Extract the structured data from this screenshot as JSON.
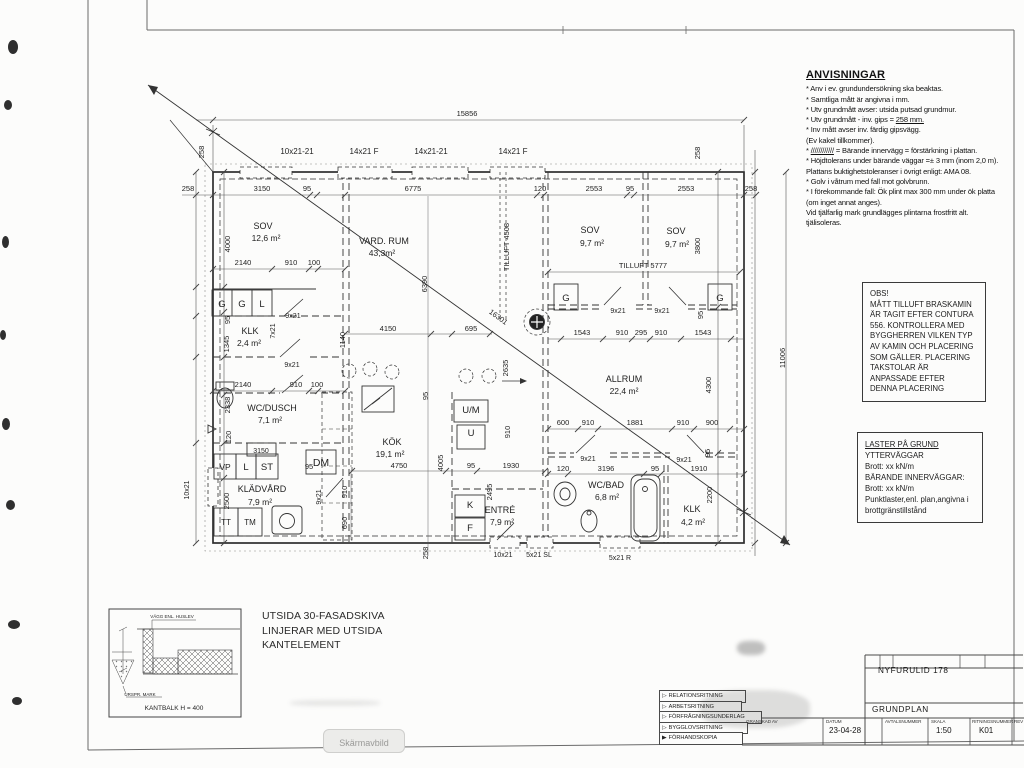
{
  "anvisningar": {
    "title": "ANVISNINGAR",
    "lines": [
      "* Anv i ev. grundundersökning ska beaktas.",
      "*  Samtliga mått är angivna i mm.",
      "* Utv grundmått avser: utsida putsad grundmur.",
      "* Utv grundmått - inv. gips =  ||258 mm.||",
      "* Inv mått avser inv. färdig gipsvägg.",
      "  (Ev kakel tillkommer).",
      "* ||////////////|| = Bärande innervägg = förstärkning i plattan.",
      "* Höjdtolerans under bärande väggar =± 3 mm (inom 2,0 m).",
      "  Plattans buktighetstoleranser i övrigt enligt:  AMA 08.",
      "* Golv i våtrum med fall mot golvbrunn.",
      "* I förekommande fall: Ök plint max 300 mm under ök platta",
      "  (om inget annat anges).",
      "  Vid tjälfarlig mark grundlägges plintarna frostfritt alt.",
      "  tjälisoleras."
    ]
  },
  "obs": {
    "lines": [
      "OBS!",
      "MÅTT TILLUFT BRASKAMIN",
      "ÄR TAGIT EFTER CONTURA",
      "556. KONTROLLERA MED",
      "BYGGHERREN VILKEN TYP",
      "AV KAMIN OCH PLACERING",
      "SOM GÄLLER. PLACERING",
      "TAKSTOLAR ÄR",
      "ANPASSADE EFTER",
      "DENNA PLACERING"
    ]
  },
  "laster": {
    "lines": [
      "||LASTER PÅ GRUND||",
      "",
      "YTTERVÄGGAR",
      "Brott: xx kN/m",
      "",
      "BÄRANDE INNERVÄGGAR:",
      "Brott: xx kN/m",
      "",
      "Punktlaster,enl. plan,angivna i",
      "brottgränstillstånd"
    ]
  },
  "detail": {
    "note_lines": [
      "UTSIDA 30-FASADSKIVA",
      "LINJERAR MED UTSIDA",
      "KANTELEMENT"
    ]
  },
  "title_block": {
    "project": "NYFURULID  178",
    "drawing": "GRUNDPLAN",
    "granskad_label": "GRANSKAD AV",
    "categories": [
      "RELATIONSRITNING",
      "ARBETSRITNING",
      "FÖRFRÅGNINGSUNDERLAG",
      "BYGGLOVSRITNING",
      "FÖRHANDSKOPIA"
    ],
    "fields": [
      {
        "label": "DATUM",
        "value": "23-04-28"
      },
      {
        "label": "AVTALSNUMMER",
        "value": ""
      },
      {
        "label": "SKALA",
        "value": "1:50"
      },
      {
        "label": "RITNINGSNUMMER",
        "value": "K01"
      },
      {
        "label": "REV",
        "value": ""
      }
    ]
  },
  "overlay": {
    "screenshot_label": "Skärmavbild"
  },
  "plan_labels": [
    {
      "t": "15856",
      "x": 467,
      "y": 116
    },
    {
      "t": "10x21-21",
      "x": 297,
      "y": 154,
      "s": 8
    },
    {
      "t": "14x21 F",
      "x": 364,
      "y": 154,
      "s": 8
    },
    {
      "t": "14x21-21",
      "x": 431,
      "y": 154,
      "s": 8
    },
    {
      "t": "14x21 F",
      "x": 513,
      "y": 154,
      "s": 8
    },
    {
      "t": "258",
      "x": 204,
      "y": 152,
      "r": -90
    },
    {
      "t": "258",
      "x": 700,
      "y": 153,
      "r": -90
    },
    {
      "t": "258",
      "x": 188,
      "y": 191
    },
    {
      "t": "3150",
      "x": 262,
      "y": 191
    },
    {
      "t": "95",
      "x": 307,
      "y": 191
    },
    {
      "t": "6775",
      "x": 413,
      "y": 191
    },
    {
      "t": "120",
      "x": 540,
      "y": 191
    },
    {
      "t": "2553",
      "x": 594,
      "y": 191
    },
    {
      "t": "95",
      "x": 630,
      "y": 191
    },
    {
      "t": "2553",
      "x": 686,
      "y": 191
    },
    {
      "t": "258",
      "x": 751,
      "y": 191
    },
    {
      "t": "4000",
      "x": 230,
      "y": 244,
      "r": -90
    },
    {
      "t": "95",
      "x": 230,
      "y": 320,
      "r": -90
    },
    {
      "t": "1345",
      "x": 229,
      "y": 344,
      "r": -90
    },
    {
      "t": "2338",
      "x": 230,
      "y": 405,
      "r": -90
    },
    {
      "t": "120",
      "x": 231,
      "y": 437,
      "r": -90
    },
    {
      "t": "2500",
      "x": 229,
      "y": 501,
      "r": -90
    },
    {
      "t": "10x21",
      "x": 189,
      "y": 490,
      "r": -90,
      "s": 7
    },
    {
      "t": "2140",
      "x": 243,
      "y": 265
    },
    {
      "t": "910",
      "x": 291,
      "y": 265
    },
    {
      "t": "100",
      "x": 314,
      "y": 265
    },
    {
      "t": "2140",
      "x": 243,
      "y": 387
    },
    {
      "t": "910",
      "x": 296,
      "y": 387
    },
    {
      "t": "100",
      "x": 317,
      "y": 387
    },
    {
      "t": "95",
      "x": 309,
      "y": 469
    },
    {
      "t": "9x21",
      "x": 293,
      "y": 318,
      "s": 7
    },
    {
      "t": "7x21",
      "x": 275,
      "y": 331,
      "r": -90,
      "s": 7
    },
    {
      "t": "9x21",
      "x": 292,
      "y": 367,
      "s": 7
    },
    {
      "t": "4150",
      "x": 388,
      "y": 331
    },
    {
      "t": "695",
      "x": 471,
      "y": 331
    },
    {
      "t": "1140",
      "x": 345,
      "y": 340,
      "r": -90
    },
    {
      "t": "6390",
      "x": 427,
      "y": 284,
      "r": -90
    },
    {
      "t": "95",
      "x": 428,
      "y": 396,
      "r": -90
    },
    {
      "t": "4005",
      "x": 443,
      "y": 463,
      "r": -90
    },
    {
      "t": "910",
      "x": 347,
      "y": 492,
      "r": -90
    },
    {
      "t": "690",
      "x": 347,
      "y": 523,
      "r": -90
    },
    {
      "t": "9x21",
      "x": 321,
      "y": 497,
      "r": -90,
      "s": 7
    },
    {
      "t": "4750",
      "x": 399,
      "y": 468
    },
    {
      "t": "95",
      "x": 471,
      "y": 468
    },
    {
      "t": "1930",
      "x": 511,
      "y": 468
    },
    {
      "t": "910",
      "x": 510,
      "y": 432,
      "r": -90
    },
    {
      "t": "2495",
      "x": 492,
      "y": 492,
      "r": -90
    },
    {
      "t": "2635",
      "x": 508,
      "y": 368,
      "r": -90
    },
    {
      "t": "TILLUFT 4508",
      "x": 509,
      "y": 247,
      "r": -90
    },
    {
      "t": "16301",
      "x": 497,
      "y": 319,
      "r": 36
    },
    {
      "t": "TILLUFT  5777",
      "x": 643,
      "y": 268
    },
    {
      "t": "3800",
      "x": 700,
      "y": 246,
      "r": -90
    },
    {
      "t": "1543",
      "x": 582,
      "y": 335
    },
    {
      "t": "910",
      "x": 622,
      "y": 335
    },
    {
      "t": "295",
      "x": 641,
      "y": 335
    },
    {
      "t": "910",
      "x": 661,
      "y": 335
    },
    {
      "t": "1543",
      "x": 703,
      "y": 335
    },
    {
      "t": "9x21",
      "x": 618,
      "y": 313,
      "s": 7
    },
    {
      "t": "9x21",
      "x": 662,
      "y": 313,
      "s": 7
    },
    {
      "t": "95",
      "x": 703,
      "y": 315,
      "r": -90
    },
    {
      "t": "600",
      "x": 563,
      "y": 425
    },
    {
      "t": "910",
      "x": 588,
      "y": 425
    },
    {
      "t": "1881",
      "x": 635,
      "y": 425
    },
    {
      "t": "910",
      "x": 683,
      "y": 425
    },
    {
      "t": "900",
      "x": 712,
      "y": 425
    },
    {
      "t": "9x21",
      "x": 588,
      "y": 461,
      "s": 7
    },
    {
      "t": "9x21",
      "x": 684,
      "y": 462,
      "s": 7
    },
    {
      "t": "95",
      "x": 710,
      "y": 453,
      "r": -90
    },
    {
      "t": "120",
      "x": 563,
      "y": 471
    },
    {
      "t": "3196",
      "x": 606,
      "y": 471
    },
    {
      "t": "95",
      "x": 655,
      "y": 471
    },
    {
      "t": "1910",
      "x": 699,
      "y": 471
    },
    {
      "t": "4300",
      "x": 711,
      "y": 385,
      "r": -90
    },
    {
      "t": "2200",
      "x": 712,
      "y": 495,
      "r": -90
    },
    {
      "t": "11006",
      "x": 785,
      "y": 358,
      "r": -90
    },
    {
      "t": "258",
      "x": 428,
      "y": 553,
      "r": -90
    },
    {
      "t": "10x21",
      "x": 503,
      "y": 557,
      "s": 7
    },
    {
      "t": "5x21 SL",
      "x": 539,
      "y": 557,
      "s": 7
    },
    {
      "t": "5x21 R",
      "x": 620,
      "y": 560,
      "s": 7
    },
    {
      "t": "SOV",
      "x": 263,
      "y": 229,
      "s": 9
    },
    {
      "t": "12,6 m²",
      "x": 266,
      "y": 241,
      "s": 8.5
    },
    {
      "t": "VARD. RUM",
      "x": 384,
      "y": 244,
      "s": 9
    },
    {
      "t": "43,3m²",
      "x": 382,
      "y": 256,
      "s": 8.5
    },
    {
      "t": "SOV",
      "x": 590,
      "y": 233,
      "s": 9
    },
    {
      "t": "9,7 m²",
      "x": 592,
      "y": 246,
      "s": 8.5
    },
    {
      "t": "SOV",
      "x": 676,
      "y": 234,
      "s": 9
    },
    {
      "t": "9,7 m²",
      "x": 677,
      "y": 247,
      "s": 8.5
    },
    {
      "t": "KLK",
      "x": 250,
      "y": 334,
      "s": 9
    },
    {
      "t": "2,4 m²",
      "x": 249,
      "y": 346,
      "s": 8.5
    },
    {
      "t": "WC/DUSCH",
      "x": 272,
      "y": 411,
      "s": 9
    },
    {
      "t": "7,1 m²",
      "x": 270,
      "y": 423,
      "s": 8.5
    },
    {
      "t": "KÖK",
      "x": 392,
      "y": 445,
      "s": 9
    },
    {
      "t": "19,1 m²",
      "x": 390,
      "y": 457,
      "s": 8.5
    },
    {
      "t": "ALLRUM",
      "x": 624,
      "y": 382,
      "s": 9
    },
    {
      "t": "22,4 m²",
      "x": 624,
      "y": 394,
      "s": 8.5
    },
    {
      "t": "KLÄDVÅRD",
      "x": 262,
      "y": 492,
      "s": 9
    },
    {
      "t": "7,9 m²",
      "x": 260,
      "y": 505,
      "s": 8.5
    },
    {
      "t": "ENTRÉ",
      "x": 500,
      "y": 513,
      "s": 9
    },
    {
      "t": "7,9 m²",
      "x": 502,
      "y": 525,
      "s": 8.5
    },
    {
      "t": "WC/BAD",
      "x": 606,
      "y": 488,
      "s": 9
    },
    {
      "t": "6,8 m²",
      "x": 607,
      "y": 500,
      "s": 8.5
    },
    {
      "t": "KLK",
      "x": 692,
      "y": 512,
      "s": 9
    },
    {
      "t": "4,2 m²",
      "x": 693,
      "y": 525,
      "s": 8.5
    },
    {
      "t": "G",
      "x": 222,
      "y": 307,
      "s": 9.5
    },
    {
      "t": "G",
      "x": 242,
      "y": 307,
      "s": 9.5
    },
    {
      "t": "L",
      "x": 262,
      "y": 307,
      "s": 9.5
    },
    {
      "t": "G",
      "x": 566,
      "y": 301,
      "s": 9.5
    },
    {
      "t": "G",
      "x": 720,
      "y": 301,
      "s": 9.5
    },
    {
      "t": "VP",
      "x": 225,
      "y": 470,
      "s": 8.5
    },
    {
      "t": "L",
      "x": 246,
      "y": 470,
      "s": 9.5
    },
    {
      "t": "ST",
      "x": 267,
      "y": 470,
      "s": 9.5
    },
    {
      "t": "3150",
      "x": 261,
      "y": 453,
      "s": 7
    },
    {
      "t": "DM",
      "x": 321,
      "y": 466,
      "s": 10.5
    },
    {
      "t": "TT",
      "x": 226,
      "y": 525,
      "s": 8
    },
    {
      "t": "TM",
      "x": 250,
      "y": 525,
      "s": 8
    },
    {
      "t": "U/M",
      "x": 471,
      "y": 413,
      "s": 9.5
    },
    {
      "t": "U",
      "x": 471,
      "y": 436,
      "s": 9.5
    },
    {
      "t": "K",
      "x": 470,
      "y": 508,
      "s": 9.5
    },
    {
      "t": "F",
      "x": 470,
      "y": 531,
      "s": 9.5
    },
    {
      "t": "VÄGG ENL. HUSLEV",
      "x": 172,
      "y": 618,
      "s": 4.5
    },
    {
      "t": "URSPR. MARK",
      "x": 140,
      "y": 696,
      "s": 4.5
    },
    {
      "t": "KANTBALK H = 400",
      "x": 174,
      "y": 710,
      "s": 6.5
    }
  ]
}
